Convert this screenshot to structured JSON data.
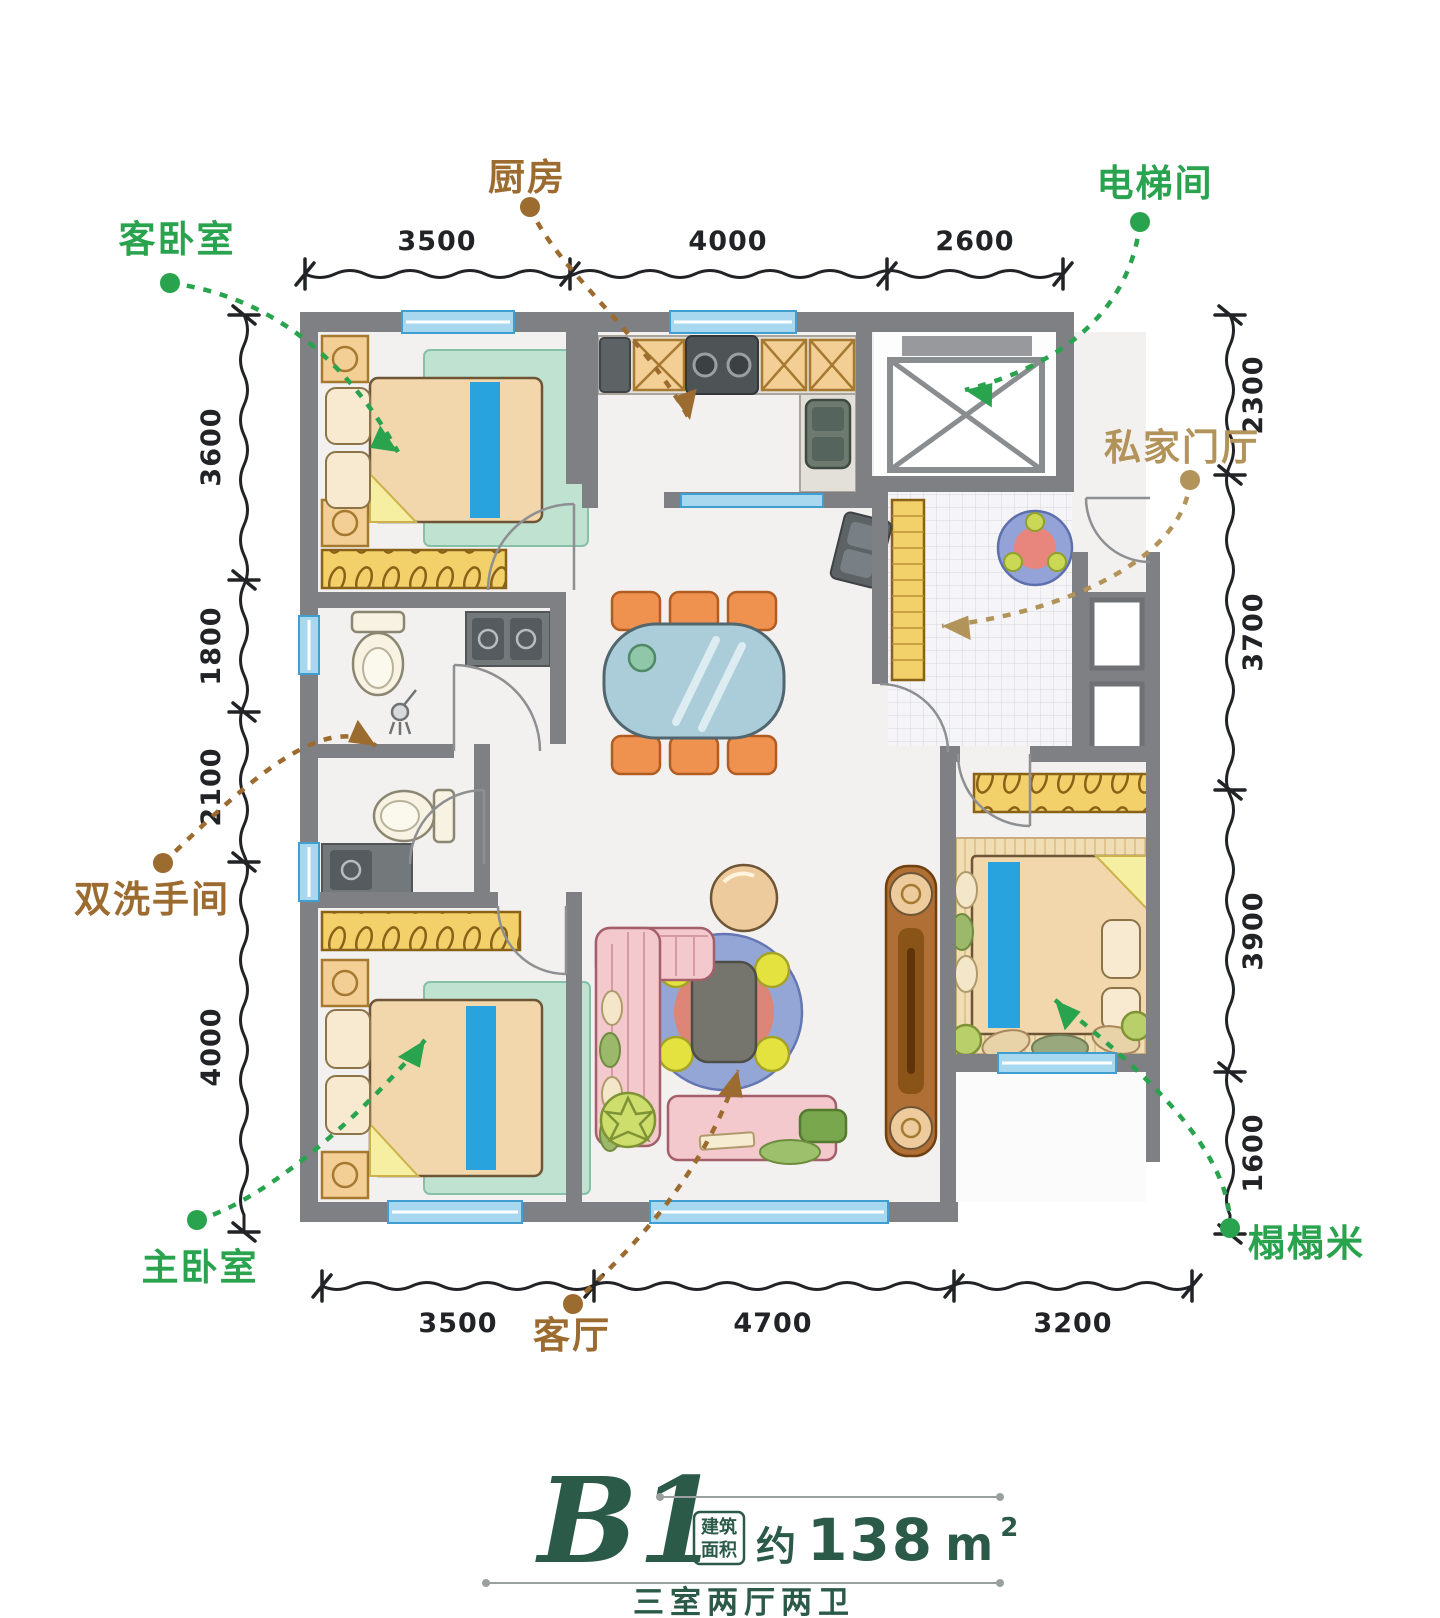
{
  "palette": {
    "label_green": "#2aa34f",
    "label_brown": "#9c6b2f",
    "label_tan": "#b2935a",
    "title_green": "#2b5a49",
    "wall_gray": "#7e8084",
    "window_blue": "#3f9fd0"
  },
  "room_labels": {
    "guest_bedroom": "客卧室",
    "kitchen": "厨房",
    "elevator": "电梯间",
    "private_foyer": "私家门厅",
    "double_bathroom": "双洗手间",
    "master_bedroom": "主卧室",
    "living_room": "客厅",
    "tatami": "榻榻米"
  },
  "dimensions": {
    "top": [
      "3500",
      "4000",
      "2600"
    ],
    "bottom": [
      "3500",
      "4700",
      "3200"
    ],
    "left": [
      "3600",
      "1800",
      "2100",
      "4000"
    ],
    "right": [
      "2300",
      "3700",
      "3900",
      "1600"
    ]
  },
  "title": {
    "plan_code": "B1",
    "badge_top": "建筑",
    "badge_bottom": "面积",
    "area_prefix": "约",
    "area_value": "138",
    "area_unit": "m",
    "area_exponent": "2",
    "subtitle": "三室两厅两卫"
  }
}
